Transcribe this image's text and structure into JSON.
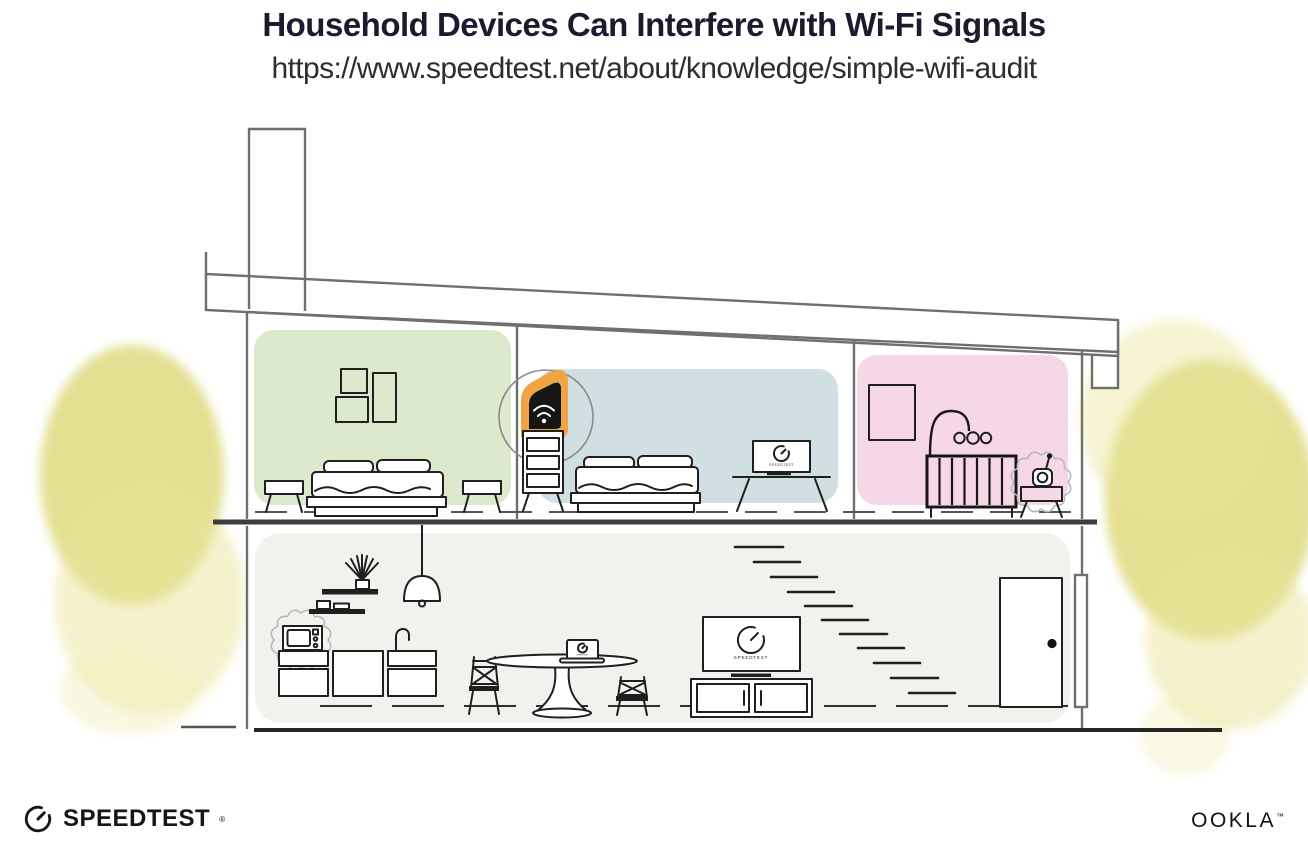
{
  "header": {
    "title": "Household Devices Can Interfere with Wi-Fi Signals",
    "url": "https://www.speedtest.net/about/knowledge/simple-wifi-audit"
  },
  "devices": {
    "bedroom_tv_text": "SPEEDTEST",
    "living_tv_text": "SPEEDTEST",
    "laptop_text": "SPEEDTEST"
  },
  "footer": {
    "speedtest": "SPEEDTEST",
    "speedtest_mark": "®",
    "ookla": "OOKLA",
    "ookla_mark": "™"
  },
  "colors": {
    "room_green": "#dde9cc",
    "room_blue": "#cfdfe2",
    "room_pink": "#f5d7e7",
    "floor_gray": "#f1f1ee",
    "router_orange": "#f1a443",
    "foliage": "#dcd878",
    "foliage_light": "#e9e59a",
    "foliage_pale": "#f1eebb",
    "title_navy": "#1a1b2e"
  }
}
